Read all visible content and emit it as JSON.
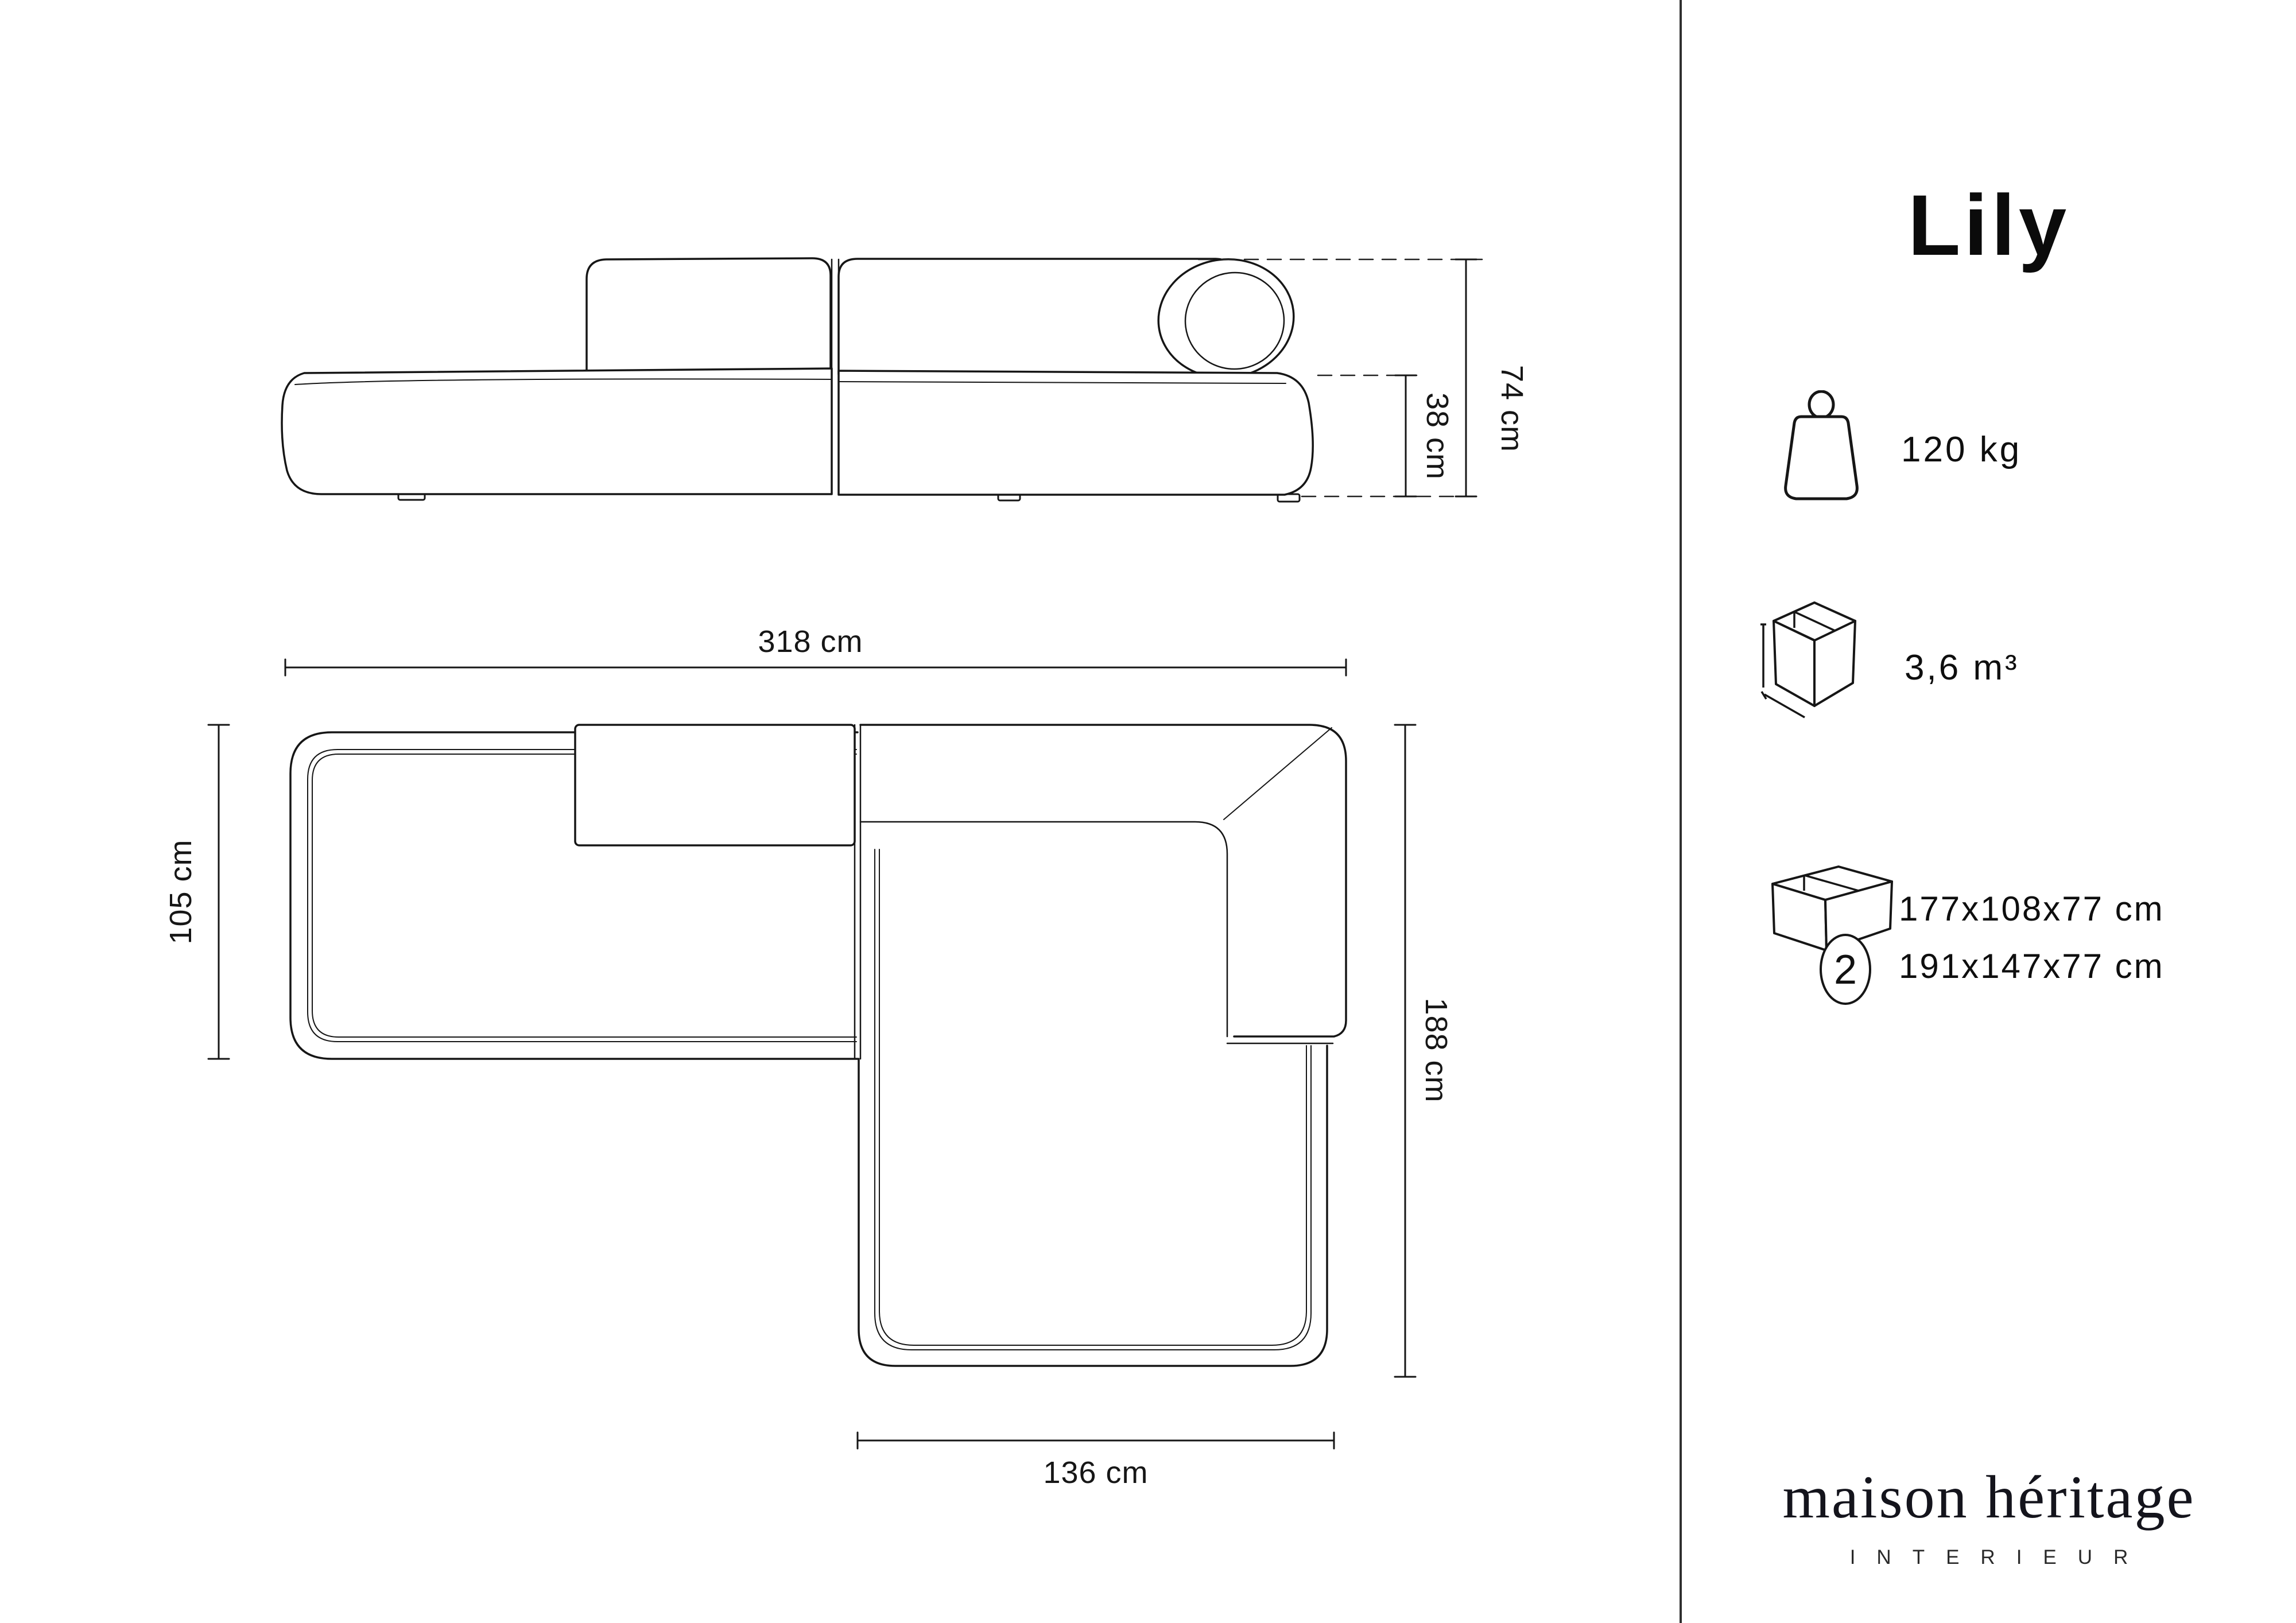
{
  "product": {
    "title": "Lily"
  },
  "specs": {
    "weight": {
      "icon": "max-weight-icon",
      "value": "120 kg"
    },
    "volume": {
      "icon": "volume-box-icon",
      "value": "3,6 m³"
    },
    "packaging": {
      "icon": "package-box-icon",
      "count": "2",
      "lines": [
        "177x108x77 cm",
        "191x147x77 cm"
      ]
    }
  },
  "dimensions": {
    "side_view": {
      "height": "74 cm",
      "seat_height": "38 cm"
    },
    "top_view": {
      "total_width": "318 cm",
      "chaise_depth": "105 cm",
      "total_depth": "188 cm",
      "chaise_width": "136 cm"
    }
  },
  "brand": {
    "name": "maison héritage",
    "tagline": "INTERIEUR"
  },
  "colors": {
    "line": "#161616",
    "divider": "#2f2f2f",
    "background": "#ffffff"
  }
}
